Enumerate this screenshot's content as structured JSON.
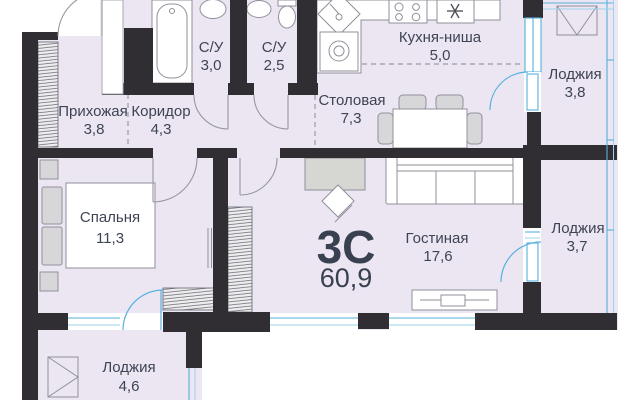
{
  "unit": {
    "type_label": "3С",
    "total_area": "60,9"
  },
  "rooms": [
    {
      "name": "Прихожая",
      "area": "3,8"
    },
    {
      "name": "Коридор",
      "area": "4,3"
    },
    {
      "name": "С/У",
      "area": "3,0"
    },
    {
      "name": "С/У",
      "area": "2,5"
    },
    {
      "name": "Кухня-ниша",
      "area": "5,0"
    },
    {
      "name": "Столовая",
      "area": "7,3"
    },
    {
      "name": "Лоджия",
      "area": "3,8"
    },
    {
      "name": "Спальня",
      "area": "11,3"
    },
    {
      "name": "Гостиная",
      "area": "17,6"
    },
    {
      "name": "Лоджия",
      "area": "3,7"
    },
    {
      "name": "Лоджия",
      "area": "4,6"
    }
  ],
  "fixtures": [
    "entry-door",
    "bathtub",
    "washbasin",
    "washbasin",
    "toilet",
    "kitchen-sink",
    "washing-machine",
    "cooktop",
    "refrigerator-snowflake",
    "dining-table",
    "dining-chairs",
    "sofa",
    "desk",
    "desk-chair",
    "bed",
    "pillows",
    "nightstands",
    "tv-stand",
    "hall-wardrobe",
    "bedroom-wardrobe",
    "living-wardrobe",
    "loggia-wardrobe-triangle",
    "loggia-wardrobe-triangle",
    "balcony-doors",
    "windows"
  ],
  "colors": {
    "wall": "#312e33",
    "room_fill": "#ebe6f2",
    "glazing": "#56b1de",
    "door_arc": "#97979f",
    "furniture_stroke": "#90909a",
    "text": "#3e4453"
  }
}
